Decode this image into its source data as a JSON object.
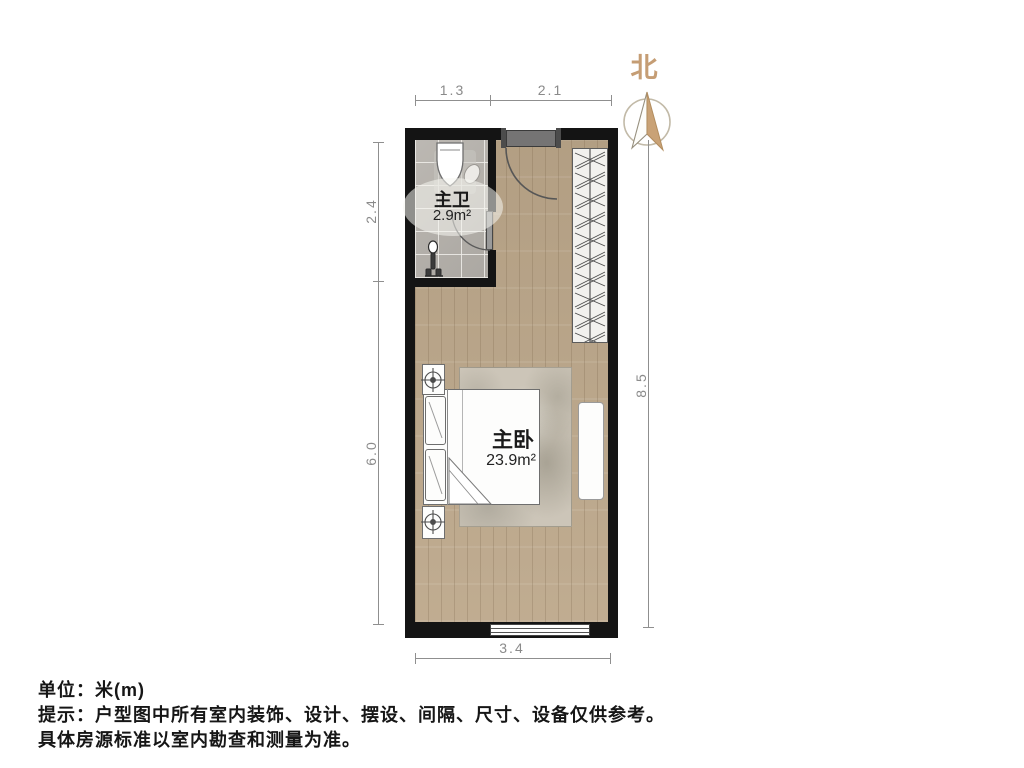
{
  "north_label": "北",
  "dimensions": {
    "top_left": "1.3",
    "top_right": "2.1",
    "left_upper": "2.4",
    "left_lower": "6.0",
    "right_side": "8.5",
    "bottom": "3.4"
  },
  "rooms": {
    "bathroom": {
      "name": "主卫",
      "area": "2.9m²"
    },
    "bedroom": {
      "name": "主卧",
      "area": "23.9m²"
    }
  },
  "footer": {
    "unit_line": "单位：米(m)",
    "tip_line": "提示：户型图中所有室内装饰、设计、摆设、间隔、尺寸、设备仅供参考。",
    "note_line": "具体房源标准以室内勘查和测量为准。"
  },
  "colors": {
    "wall": "#141414",
    "wood_floor": "#bca78a",
    "tile_floor": "#b6b2ac",
    "north_accent": "#c59d74",
    "dimension_gray": "#8a8a8a"
  }
}
